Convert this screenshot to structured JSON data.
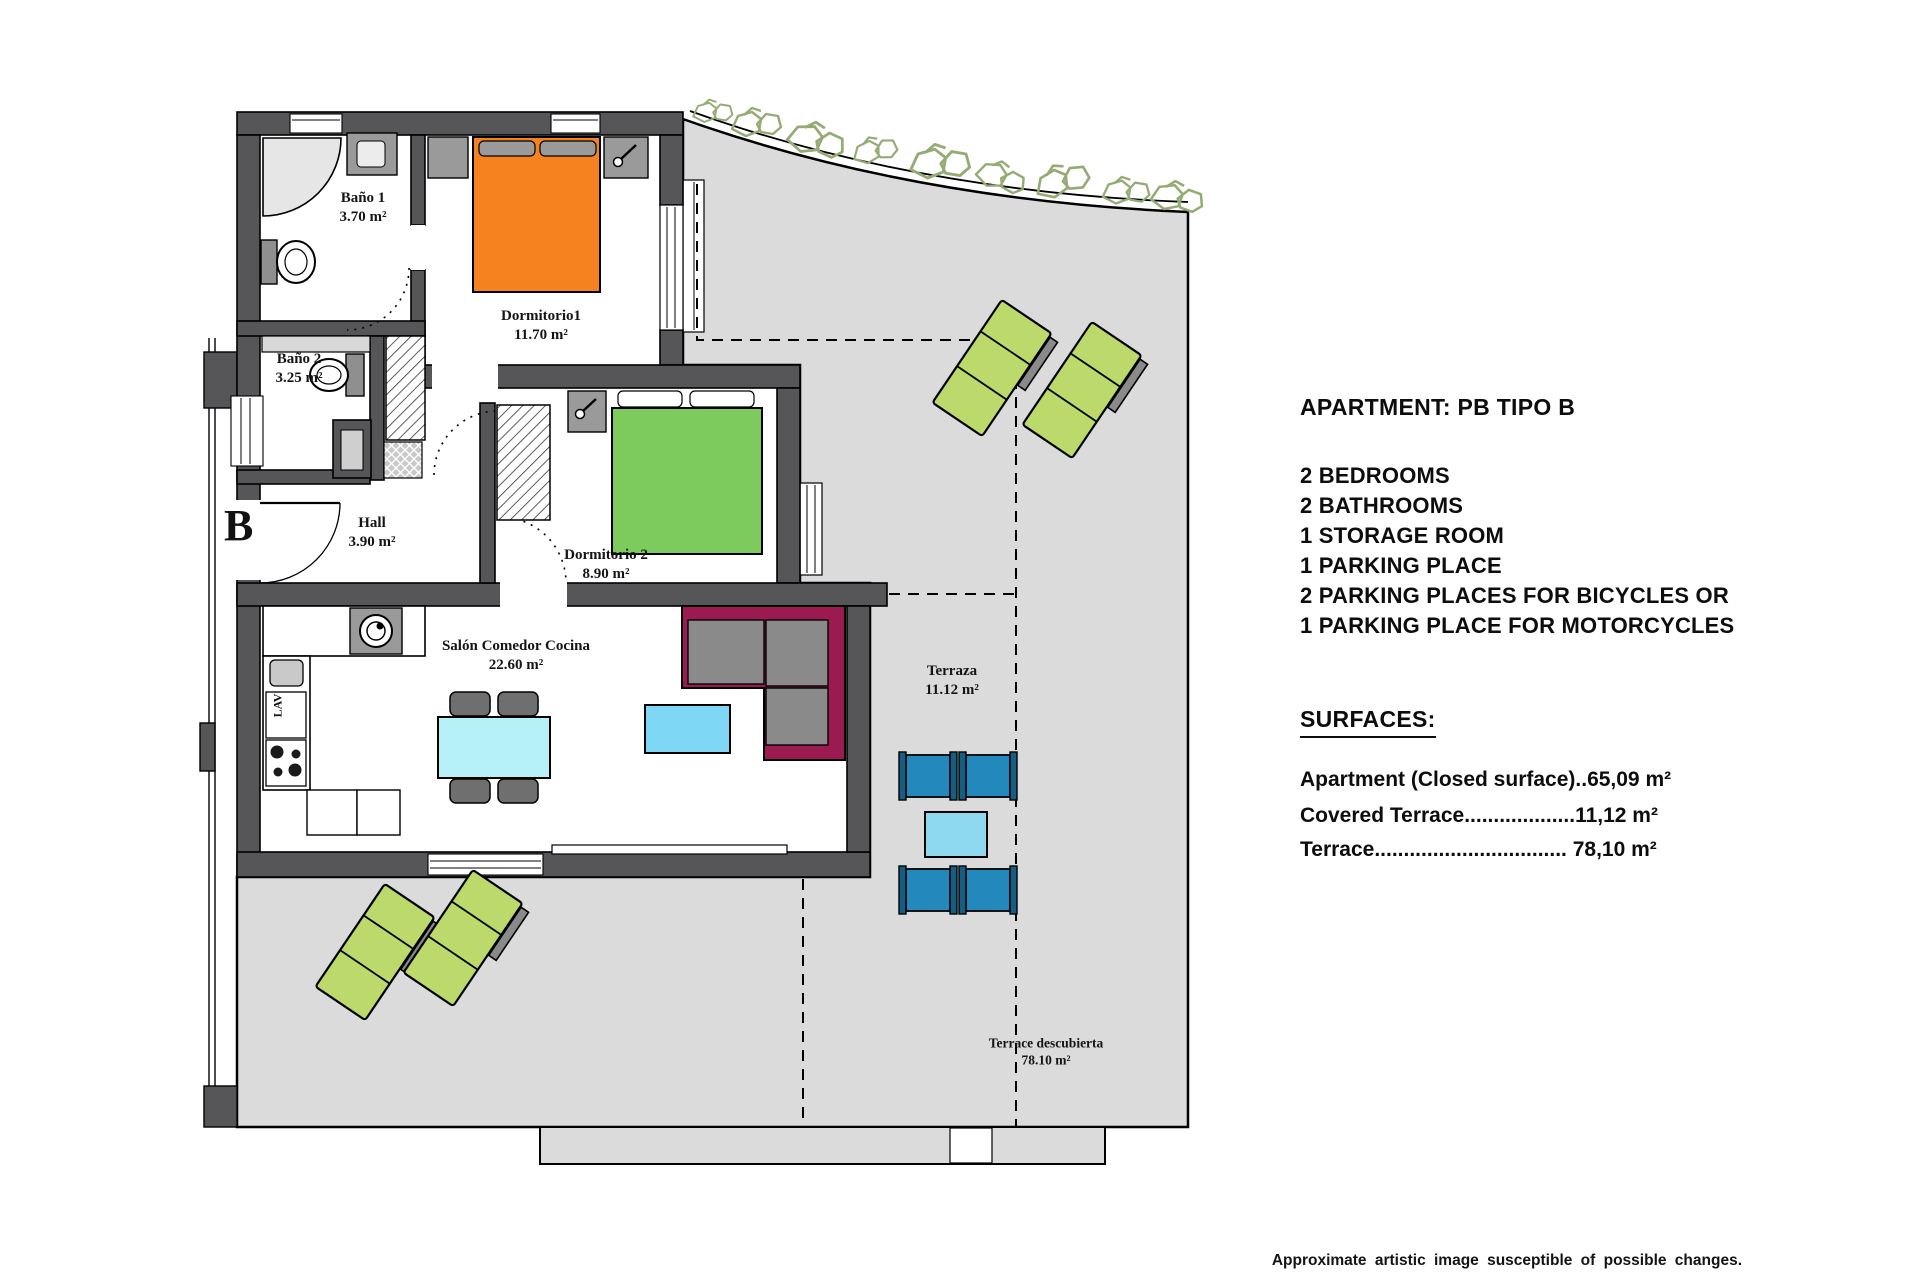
{
  "floor_plan": {
    "block_letter": "B",
    "kitchen_label": "LAV",
    "rooms": {
      "bano1": {
        "name": "Baño 1",
        "area": "3.70 m²"
      },
      "bano2": {
        "name": "Baño 2",
        "area": "3.25 m²"
      },
      "hall": {
        "name": "Hall",
        "area": "3.90 m²"
      },
      "dorm1": {
        "name": "Dormitorio1",
        "area": "11.70 m²"
      },
      "dorm2": {
        "name": "Dormitorio 2",
        "area": "8.90 m²"
      },
      "salon": {
        "name": "Salón Comedor Cocina",
        "area": "22.60 m²"
      },
      "terraza": {
        "name": "Terraza",
        "area": "11.12 m²"
      },
      "terrace_open": {
        "name": "Terrace descubierta",
        "area": "78.10 m²"
      }
    },
    "colors": {
      "wall_gray": "#565659",
      "terrace_gray": "#DBDBDB",
      "bed_orange": "#F5821E",
      "bed_green": "#7DCB5C",
      "lounger_green": "#BCD96B",
      "sofa_magenta": "#9B1B50",
      "dining_table_cyan": "#B5F1F7",
      "coffee_table_blue": "#7ED7F5",
      "terrace_chair_blue": "#2389BC",
      "terrace_table_blue": "#8FD9F0",
      "plant_olive": "#94AB74"
    }
  },
  "info_panel": {
    "title": "APARTMENT: PB TIPO B",
    "features": [
      "2 BEDROOMS",
      "2 BATHROOMS",
      "1 STORAGE ROOM",
      "1 PARKING PLACE",
      "2 PARKING PLACES FOR BICYCLES OR",
      "1 PARKING PLACE FOR MOTORCYCLES"
    ],
    "surfaces_heading": "SURFACES:",
    "surfaces": [
      {
        "label": "Apartment (Closed surface)",
        "dots": "..",
        "value": "65,09 m²"
      },
      {
        "label": "Covered Terrace",
        "dots": "...................",
        "value": "11,12 m²"
      },
      {
        "label": "Terrace",
        "dots": ".................................",
        "value": " 78,10 m²"
      }
    ]
  },
  "footer": {
    "disclaimer": "Approximate artistic image susceptible of possible changes."
  }
}
